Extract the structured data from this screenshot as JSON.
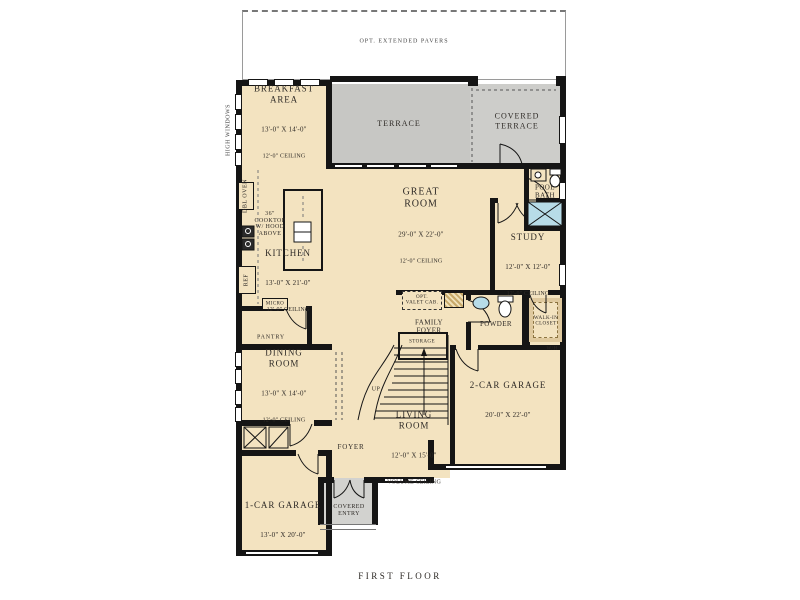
{
  "title": "FIRST FLOOR",
  "annotations": {
    "pavers": "OPT. EXTENDED PAVERS",
    "high_windows": "HIGH WINDOWS",
    "terrace": "TERRACE",
    "covered_terrace": "COVERED\nTERRACE",
    "pool_bath": "POOL\nBATH",
    "cooktop_note": "36\"\nCOOKTOP\nW/ HOOD\nABOVE",
    "dbl_oven": "DBL OVEN",
    "ref": "REF",
    "micro": "MICRO",
    "pantry": "PANTRY",
    "opt_valet": "OPT.\nVALET CAB.",
    "family_foyer": "FAMILY\nFOYER",
    "powder": "POWDER",
    "walk_in_closet": "WALK-IN\nCLOSET",
    "storage": "STORAGE",
    "wh": "W/H",
    "up": "UP",
    "foyer": "FOYER",
    "covered_entry": "COVERED\nENTRY"
  },
  "rooms": [
    {
      "name": "BREAKFAST\nAREA",
      "dims": "13'-0\" X 14'-0\"",
      "ceiling": "12'-0\" CEILING"
    },
    {
      "name": "GREAT\nROOM",
      "dims": "29'-0\" X 22'-0\"",
      "ceiling": "12'-0\" CEILING"
    },
    {
      "name": "KITCHEN",
      "dims": "13'-0\" X 21'-0\"",
      "ceiling": "12'-0\" CEILING"
    },
    {
      "name": "STUDY",
      "dims": "12'-0\" X 12'-0\"",
      "ceiling": "12'-0\" CEILING"
    },
    {
      "name": "DINING\nROOM",
      "dims": "13'-0\" X 14'-0\"",
      "ceiling": "12'-0\" CEILING"
    },
    {
      "name": "LIVING\nROOM",
      "dims": "12'-0\" X 15'-0\"",
      "ceiling": "VOLUME CEILING"
    },
    {
      "name": "2-CAR GARAGE",
      "dims": "20'-0\" X 22'-0\"",
      "ceiling": ""
    },
    {
      "name": "1-CAR GARAGE",
      "dims": "13'-0\" X 20'-0\"",
      "ceiling": ""
    }
  ],
  "colors": {
    "room_fill": "#F3E3C0",
    "terrace_fill": "#C7C7C4",
    "covered_entry_fill": "#D2D2CF",
    "wall": "#151515",
    "shower": "#B7DCE8"
  }
}
